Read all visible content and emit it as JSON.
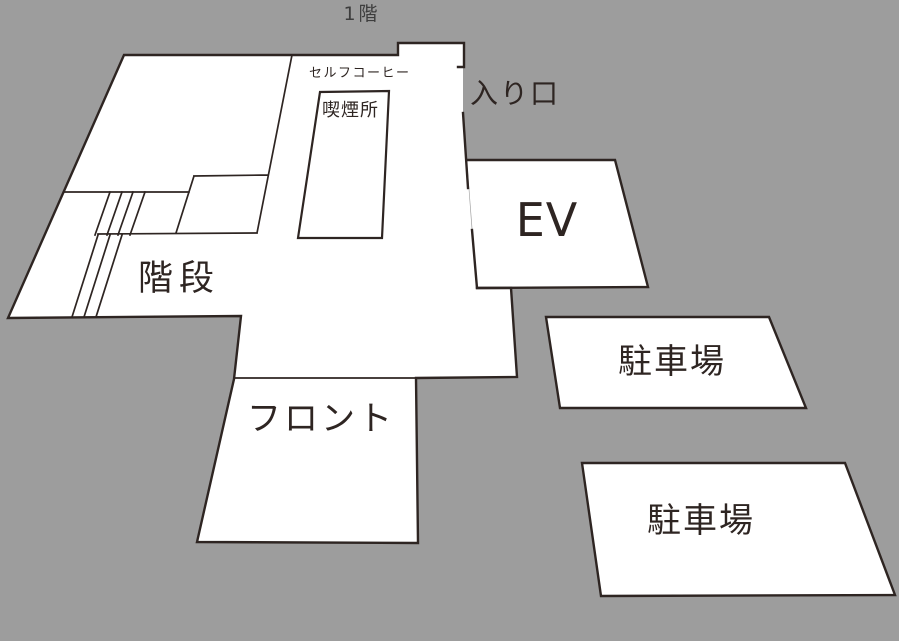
{
  "title": "1階",
  "colors": {
    "background": "#9d9d9d",
    "line": "#2e2522",
    "room_fill": "#ffffff",
    "text": "#2e2522",
    "title_text": "#3d3d3d"
  },
  "rooms": [
    {
      "id": "smoking-area",
      "label": "喫煙所"
    },
    {
      "id": "self-coffee",
      "label": "セルフコーヒー"
    },
    {
      "id": "entrance",
      "label": "入り口"
    },
    {
      "id": "elevator",
      "label": "EV"
    },
    {
      "id": "stairs",
      "label": "階段"
    },
    {
      "id": "front-desk",
      "label": "フロント"
    },
    {
      "id": "parking-1",
      "label": "駐車場"
    },
    {
      "id": "parking-2",
      "label": "駐車場"
    }
  ],
  "floorplan": {
    "shapes": [
      {
        "name": "main-building-fill",
        "kind": "polygon",
        "fill": true,
        "stroke": false,
        "w": 0,
        "points": "124,55 398,55 398,43 464,43 463,67 463,113 476,287 477,288 511,288 517,377 416,378 418,543 197,542 234,379 241,316 8,318"
      },
      {
        "name": "ev-room-shape",
        "kind": "polygon",
        "fill": true,
        "stroke": false,
        "w": 0,
        "points": "467,160 615,160 648,287 477,288"
      },
      {
        "name": "ev-room-outline",
        "kind": "path",
        "fill": false,
        "stroke": true,
        "w": 2.4,
        "d": "M467,160 L615,160 L648,287 L477,288"
      },
      {
        "name": "main-building-outline",
        "kind": "path",
        "fill": false,
        "stroke": true,
        "w": 2.4,
        "d": "M458,67 L464,67 L464,43 L398,43 L398,55 L124,55 L8,318 L241,316 L234,379 L197,542 L418,543 L416,378 L517,377 L511,288 L477,288 L472,230 M468,188 L463,113"
      },
      {
        "name": "interior-walls",
        "kind": "path",
        "fill": false,
        "stroke": true,
        "w": 1.7,
        "d": "M234,378 L416,378 M292,55 L257,233 M194,176 L268,175 M194,176 L176,233 M64,192 L189,192 M98,234 L257,233"
      },
      {
        "name": "stairs-hatching",
        "kind": "path",
        "fill": false,
        "stroke": true,
        "w": 1.7,
        "d": "M110,192 L95,235 M122,192 L107,235 M133,192 L118,235 M145,192 L130,235 M98,235 L72,317 M110,235 L84,317 M122,235 L96,317"
      },
      {
        "name": "smoking-room-shape",
        "kind": "polygon",
        "fill": true,
        "stroke": true,
        "w": 2.2,
        "points": "320,92 389,91 382,238 298,238"
      },
      {
        "name": "parking-lot-1-shape",
        "kind": "polygon",
        "fill": true,
        "stroke": true,
        "w": 2.4,
        "points": "546,317 769,317 806,408 560,408"
      },
      {
        "name": "parking-lot-2-shape",
        "kind": "polygon",
        "fill": true,
        "stroke": true,
        "w": 2.4,
        "points": "582,463 845,463 895,595 601,596"
      }
    ],
    "labels": [
      {
        "name": "floor-title",
        "text": "1階",
        "x": 362,
        "y": 20,
        "size": 19,
        "anchor": "middle",
        "spacing": 3,
        "use_title_color": true
      },
      {
        "name": "label-self-coffee",
        "text": "セルフコーヒー",
        "x": 309,
        "y": 77,
        "size": 13,
        "anchor": "start",
        "spacing": 1.5
      },
      {
        "name": "label-smoking-area",
        "text": "喫煙所",
        "x": 322,
        "y": 116,
        "size": 18,
        "anchor": "start",
        "spacing": 1
      },
      {
        "name": "label-entrance",
        "text": "入り口",
        "x": 470,
        "y": 103,
        "size": 28,
        "anchor": "start",
        "spacing": 2
      },
      {
        "name": "label-ev",
        "text": "EV",
        "x": 547,
        "y": 236,
        "size": 46,
        "anchor": "middle",
        "spacing": 1
      },
      {
        "name": "label-stairs",
        "text": "階段",
        "x": 138,
        "y": 290,
        "size": 35,
        "anchor": "start",
        "spacing": 6
      },
      {
        "name": "label-front-desk",
        "text": "フロント",
        "x": 247,
        "y": 430,
        "size": 34,
        "anchor": "start",
        "spacing": 3
      },
      {
        "name": "label-parking-1",
        "text": "駐車場",
        "x": 672,
        "y": 373,
        "size": 34,
        "anchor": "middle",
        "spacing": 2
      },
      {
        "name": "label-parking-2",
        "text": "駐車場",
        "x": 701,
        "y": 532,
        "size": 34,
        "anchor": "middle",
        "spacing": 2
      }
    ]
  }
}
